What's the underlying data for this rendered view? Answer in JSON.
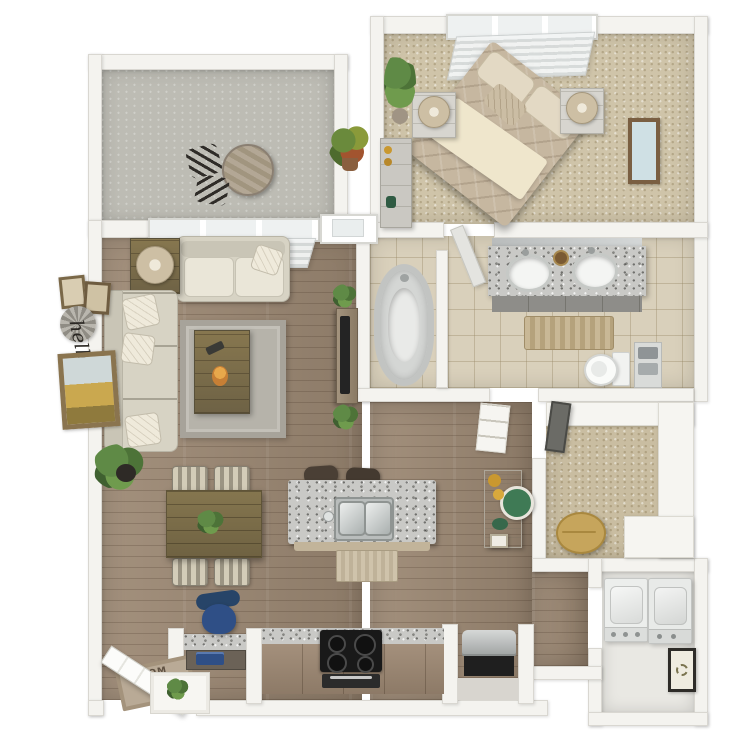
{
  "scene": {
    "description": "3D rendered top-down floor plan of a one-bedroom apartment with balcony, living-dining room, kitchen, bedroom, bathroom, walk-in closet and laundry",
    "background": "#ffffff"
  },
  "texts": {
    "wall_script": "hello",
    "doormat_word": "HOM",
    "doormat_script": "Su"
  },
  "palette": {
    "white": "#ffffff",
    "wall": "#f4f3ef",
    "wallEdge": "#d9d7d1",
    "wood": "#9c8873",
    "carpetBed": "#cfc4a9",
    "carpetCloset": "#c9bda1",
    "tile": "#d9d0bb",
    "concrete": "#bdbcb4",
    "granite": "#c9c9c6",
    "counter": "#9a8774",
    "sofa": "#d7d3c4",
    "cushion": "#eae6d8",
    "rug": "#b6b3aa",
    "leaf": "#5f8a46",
    "navy": "#2f4f86",
    "green": "#3f7a55",
    "amber": "#c9982f",
    "dark": "#22211f",
    "steel": "#c7c9c8",
    "fixture": "#f3f4f2",
    "matText": "#5f5142"
  },
  "rooms": [
    {
      "name": "balcony",
      "floor": "concrete",
      "furniture": [
        "bistro-table",
        "bistro-chair",
        "bistro-chair",
        "croton-plant"
      ]
    },
    {
      "name": "living-dining-room",
      "floor": "hardwood",
      "furniture": [
        "loveseat",
        "sectional-sofa",
        "corner-table-with-lamp",
        "coffee-table",
        "area-rug",
        "tv-console",
        "potted-plant",
        "dining-table",
        "dining-chairs",
        "wall-frames",
        "windmill-decor",
        "hello-script",
        "large-frame"
      ]
    },
    {
      "name": "kitchen",
      "floor": "hardwood",
      "furniture": [
        "island-with-double-sink",
        "bar-stools",
        "floor-mat",
        "counter-with-stove",
        "oven",
        "steel-appliance",
        "console-table",
        "desk-nook",
        "office-chair",
        "laptop"
      ]
    },
    {
      "name": "entry",
      "floor": "hardwood",
      "furniture": [
        "entry-door",
        "doormat",
        "entry-cabinet",
        "plant"
      ]
    },
    {
      "name": "bedroom",
      "floor": "carpet",
      "furniture": [
        "queen-bed",
        "nightstand-with-lamp",
        "nightstand-with-lamp",
        "dresser",
        "tall-plant",
        "wall-frame",
        "window-blinds"
      ]
    },
    {
      "name": "bathroom",
      "floor": "tile",
      "furniture": [
        "bathtub",
        "double-vanity",
        "toilet",
        "towel-shelf",
        "bath-rug",
        "door"
      ]
    },
    {
      "name": "walk-in-closet",
      "floor": "carpet",
      "furniture": [
        "shelving",
        "pouf",
        "mirror"
      ]
    },
    {
      "name": "laundry",
      "floor": "vinyl",
      "furniture": [
        "washer",
        "dryer",
        "wreath-frame"
      ]
    }
  ]
}
